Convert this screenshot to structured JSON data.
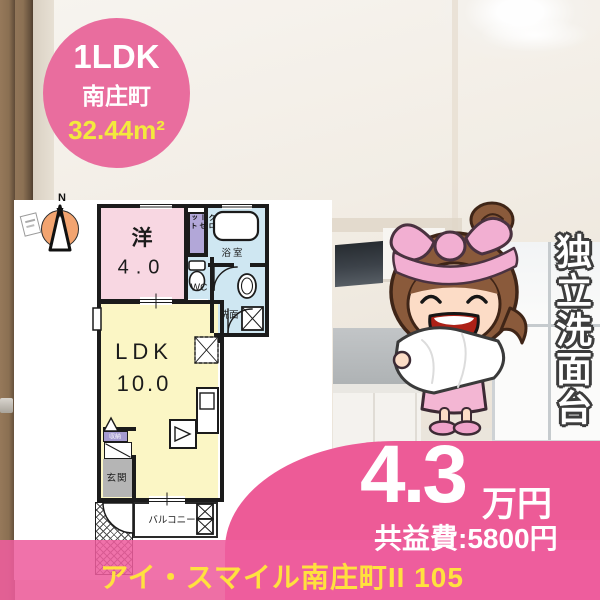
{
  "badge": {
    "type": "1LDK",
    "area_name": "南庄町",
    "size": "32.44m²"
  },
  "compass": {
    "label": "N"
  },
  "floorplan": {
    "western_room": {
      "label": "洋",
      "size": "4.0"
    },
    "closet": {
      "label": "クローゼット"
    },
    "bath": {
      "label": "浴室"
    },
    "wc": {
      "label": "WC"
    },
    "washroom": {
      "label": "洗面"
    },
    "ldk": {
      "label": "LDK",
      "size": "10.0"
    },
    "storage": {
      "label": "収納"
    },
    "entrance": {
      "label": "玄関"
    },
    "balcony": {
      "label": "バルコニー"
    }
  },
  "feature": {
    "vertical_text": "独立洗面台"
  },
  "price": {
    "amount": "4.3",
    "unit": "万円",
    "common_fee": "共益費:5800円"
  },
  "footer": {
    "property_name": "アイ・スマイル南庄町II 105"
  },
  "colors": {
    "accent_pink": "#ed5b97",
    "badge_pink": "#e96d9e",
    "highlight_yellow": "#f3e93c",
    "footer_yellow": "#ffe13e",
    "plan_pink_room": "#f8d7e2",
    "plan_yellow_room": "#fbf6c5",
    "plan_blue_room": "#cfe7f2",
    "plan_purple_closet": "#b2a7d8",
    "plan_gray_entrance": "#b5b5b5"
  }
}
